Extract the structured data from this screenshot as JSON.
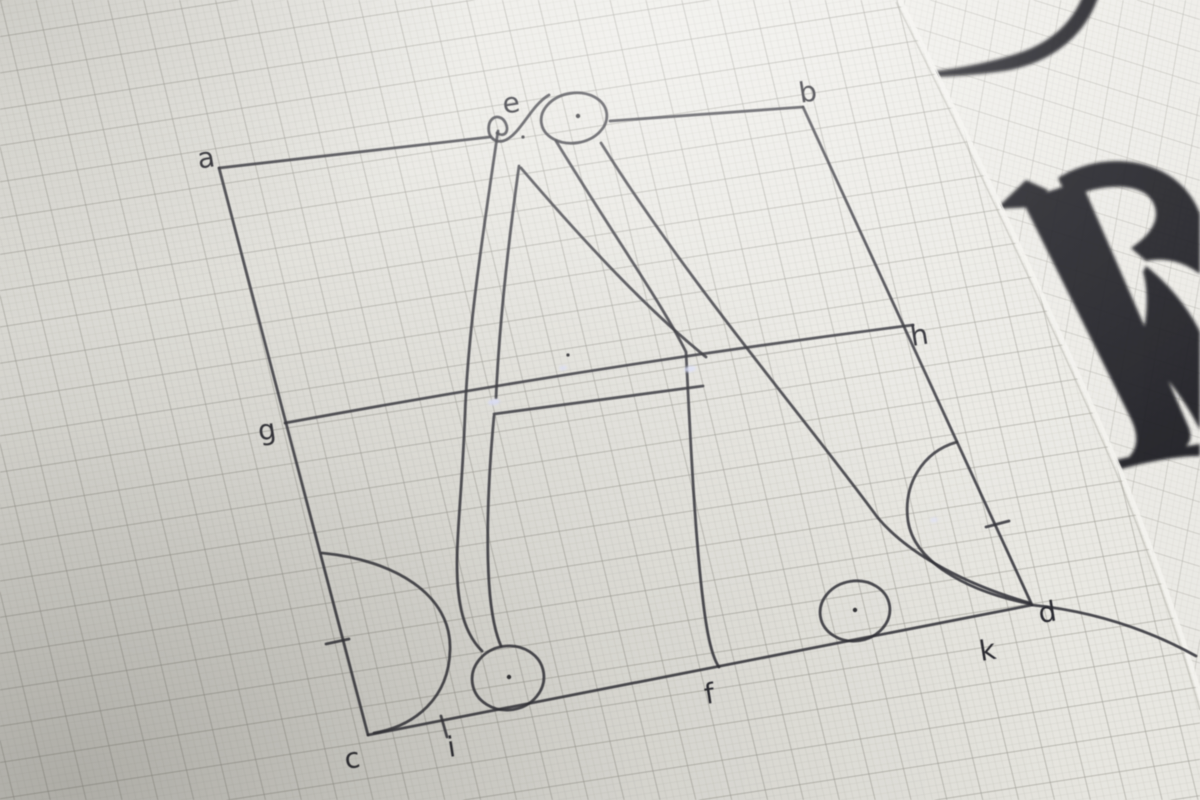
{
  "scene": {
    "drawn_letter": "A",
    "construction_point_labels": [
      "a",
      "b",
      "e",
      "g",
      "h",
      "c",
      "i",
      "f",
      "k",
      "d"
    ]
  },
  "diagram": {
    "points": [
      {
        "id": "a",
        "label": "a"
      },
      {
        "id": "b",
        "label": "b"
      },
      {
        "id": "e",
        "label": "e"
      },
      {
        "id": "g",
        "label": "g"
      },
      {
        "id": "h",
        "label": "h"
      },
      {
        "id": "c",
        "label": "c"
      },
      {
        "id": "i",
        "label": "i"
      },
      {
        "id": "f",
        "label": "f"
      },
      {
        "id": "k",
        "label": "k"
      },
      {
        "id": "d",
        "label": "d"
      }
    ]
  },
  "background_sheet": {
    "visible_printed_glyph": "R"
  },
  "colors": {
    "paper_front": "#e8e7e1",
    "paper_back": "#f0efeb",
    "grid_fine": "#a9a89f",
    "grid_major": "#7d7c74",
    "ink": "#303036",
    "printed_glyph": "#17171a",
    "glint": "#dfe3ff"
  }
}
